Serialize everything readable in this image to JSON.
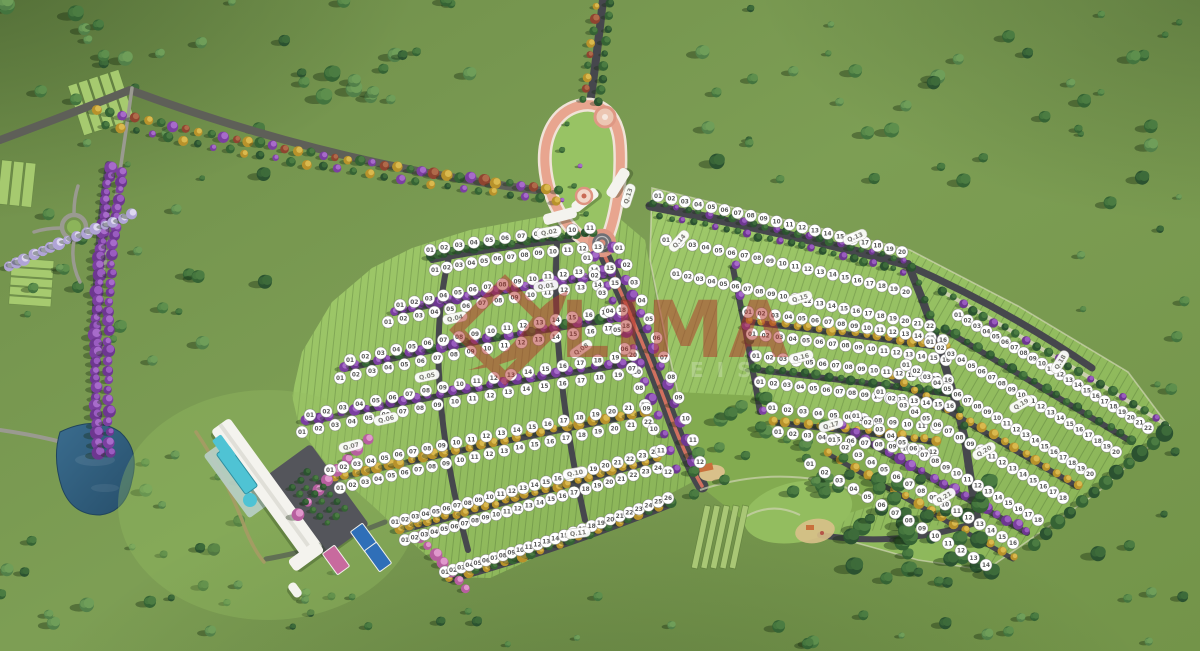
{
  "watermark": {
    "brand": "LIMA",
    "subtext": "EIS",
    "color": "#b23229"
  },
  "colors": {
    "field": "#74924c",
    "lot": "#98c364",
    "lot_light": "#a6cf6e",
    "road": "#46474d",
    "road_light": "#9a9a90",
    "path_tan": "#b08a66",
    "water": "#2e5a7a",
    "entrance_pink": "#e8a58f",
    "sidewalk": "#f0e3d8",
    "median_red": "#d0705f",
    "building": "#f4f3ee",
    "pool": "#4fc3d4",
    "court_blue": "#2f6fb8",
    "court_pink": "#c86a9e",
    "parking": "#54555b",
    "sand": "#d9c08a",
    "garden": "#a9c775",
    "badge_bg": "#ffffff",
    "badge_text": "#5a5a5a",
    "label_text": "#7a7a74",
    "park_green": "#83ab50",
    "boundary_line": "#e0ddc6"
  },
  "blocks": [
    {
      "id": "q01",
      "label": "Q.01",
      "x": 546,
      "y": 286,
      "rot": -8
    },
    {
      "id": "q02",
      "label": "Q.02",
      "x": 549,
      "y": 232,
      "rot": -10
    },
    {
      "id": "q04",
      "label": "Q.04",
      "x": 455,
      "y": 318,
      "rot": -12
    },
    {
      "id": "q05",
      "label": "Q.05",
      "x": 427,
      "y": 376,
      "rot": -12
    },
    {
      "id": "q06",
      "label": "Q.06",
      "x": 386,
      "y": 419,
      "rot": -13
    },
    {
      "id": "q07",
      "label": "Q.07",
      "x": 351,
      "y": 446,
      "rot": -14
    },
    {
      "id": "q08",
      "label": "Q.08",
      "x": 581,
      "y": 349,
      "rot": -35
    },
    {
      "id": "q10",
      "label": "Q.10",
      "x": 575,
      "y": 473,
      "rot": -10
    },
    {
      "id": "q11",
      "label": "Q.11",
      "x": 578,
      "y": 533,
      "rot": -8
    },
    {
      "id": "q13",
      "label": "Q.13",
      "x": 628,
      "y": 196,
      "rot": -72
    },
    {
      "id": "q13b",
      "label": "Q.13",
      "x": 855,
      "y": 237,
      "rot": -22
    },
    {
      "id": "q14",
      "label": "Q.14",
      "x": 679,
      "y": 241,
      "rot": -48
    },
    {
      "id": "q15",
      "label": "Q.15",
      "x": 800,
      "y": 298,
      "rot": -16
    },
    {
      "id": "q16",
      "label": "Q.16",
      "x": 801,
      "y": 357,
      "rot": -14
    },
    {
      "id": "q17",
      "label": "Q.17",
      "x": 831,
      "y": 425,
      "rot": -16
    },
    {
      "id": "q18",
      "label": "Q.18",
      "x": 1060,
      "y": 362,
      "rot": -58
    },
    {
      "id": "q19",
      "label": "Q.19",
      "x": 1021,
      "y": 404,
      "rot": -30
    },
    {
      "id": "q20",
      "label": "Q.20",
      "x": 984,
      "y": 451,
      "rot": -30
    },
    {
      "id": "q21",
      "label": "Q.21",
      "x": 944,
      "y": 497,
      "rot": -30
    }
  ],
  "lot_rows": [
    {
      "id": "a1",
      "block": "Q.02",
      "count": 11
    },
    {
      "id": "a2",
      "block": "Q.01",
      "count": 13
    },
    {
      "id": "a3",
      "block": "Q.01",
      "count": 15
    },
    {
      "id": "a4",
      "block": "Q.04",
      "count": 15
    },
    {
      "id": "a5",
      "block": "Q.04",
      "count": 18
    },
    {
      "id": "a6",
      "block": "Q.05",
      "count": 18
    },
    {
      "id": "a7",
      "block": "Q.05",
      "count": 20
    },
    {
      "id": "a8",
      "block": "Q.06",
      "count": 20
    },
    {
      "id": "a9",
      "block": "Q.07",
      "count": 22
    },
    {
      "id": "a10",
      "block": "Q.10",
      "count": 22
    },
    {
      "id": "a11",
      "block": "Q.10",
      "count": 24
    },
    {
      "id": "a12",
      "block": "Q.11",
      "count": 24
    },
    {
      "id": "a13",
      "block": "Q.11",
      "count": 26
    },
    {
      "id": "b1",
      "block": "Q.13",
      "count": 20
    },
    {
      "id": "b2",
      "block": "Q.14",
      "count": 20
    },
    {
      "id": "b3",
      "block": "Q.14",
      "count": 22
    },
    {
      "id": "m1",
      "block": "Q.15",
      "count": 16
    },
    {
      "id": "m2",
      "block": "Q.15",
      "count": 16
    },
    {
      "id": "m3",
      "block": "Q.16",
      "count": 16
    },
    {
      "id": "m4",
      "block": "Q.16",
      "count": 16
    },
    {
      "id": "m5",
      "block": "Q.17",
      "count": 12
    },
    {
      "id": "m6",
      "block": "Q.17",
      "count": 12
    },
    {
      "id": "c1",
      "block": "Q.18",
      "count": 22
    },
    {
      "id": "c2",
      "block": "Q.19",
      "count": 20
    },
    {
      "id": "c3",
      "block": "Q.19",
      "count": 20
    },
    {
      "id": "c4",
      "block": "Q.20",
      "count": 18
    },
    {
      "id": "c5",
      "block": "Q.20",
      "count": 18
    },
    {
      "id": "c6",
      "block": "Q.21",
      "count": 16
    },
    {
      "id": "c7",
      "block": "Q.21",
      "count": 14
    },
    {
      "id": "s1",
      "block": "Q.14",
      "count": 12
    },
    {
      "id": "s2",
      "block": "Q.08",
      "count": 12
    }
  ],
  "features": {
    "lake": "lake",
    "clubhouse": "clubhouse building",
    "pools": "swimming pools",
    "parking": "parking lot",
    "courts": "sports courts",
    "entrance": "entrance gateway boulevard",
    "plaza": "entrance plaza",
    "canopies": "gatehouse canopies",
    "park": "central park",
    "playground": "playground",
    "garden": "community garden",
    "forest": "forest reserve",
    "avenue": "tree-lined avenue",
    "roundabout": "roundabout",
    "farm_strips": "planted strips"
  }
}
